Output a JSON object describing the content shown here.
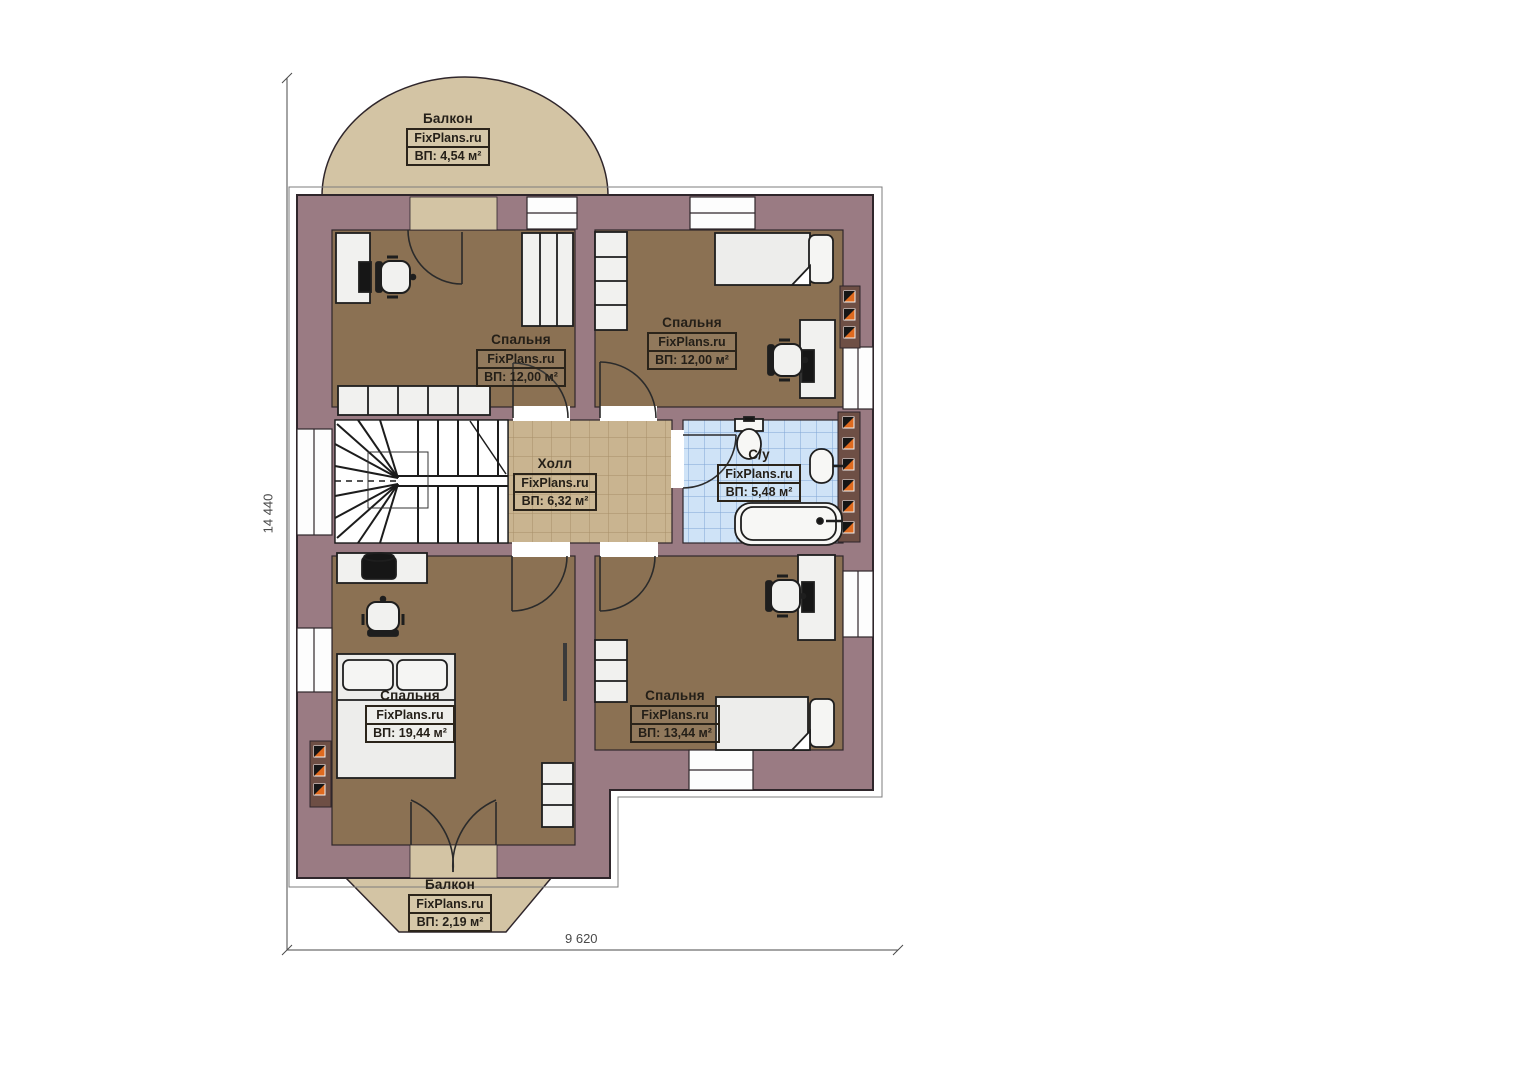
{
  "plan": {
    "watermark": "FixPlans.ru",
    "rooms": [
      {
        "id": "balcony-top",
        "name": "Балкон",
        "watermark": "FixPlans.ru",
        "area": "ВП: 4,54 м²"
      },
      {
        "id": "bedroom-top-left",
        "name": "Спальня",
        "watermark": "FixPlans.ru",
        "area": "ВП: 12,00 м²"
      },
      {
        "id": "bedroom-top-right",
        "name": "Спальня",
        "watermark": "FixPlans.ru",
        "area": "ВП: 12,00 м²"
      },
      {
        "id": "hall",
        "name": "Холл",
        "watermark": "FixPlans.ru",
        "area": "ВП: 6,32 м²"
      },
      {
        "id": "bathroom",
        "name": "С/у",
        "watermark": "FixPlans.ru",
        "area": "ВП: 5,48 м²"
      },
      {
        "id": "bedroom-bottom-left",
        "name": "Спальня",
        "watermark": "FixPlans.ru",
        "area": "ВП: 19,44 м²"
      },
      {
        "id": "bedroom-bottom-right",
        "name": "Спальня",
        "watermark": "FixPlans.ru",
        "area": "ВП: 13,44 м²"
      },
      {
        "id": "balcony-bottom",
        "name": "Балкон",
        "watermark": "FixPlans.ru",
        "area": "ВП: 2,19 м²"
      }
    ],
    "dimensions": {
      "vertical": "14 440",
      "horizontal": "9 620"
    },
    "colors": {
      "wall": "#9a7b83",
      "bedroom_floor": "#8b7153",
      "hall_floor": "#c9b490",
      "bathroom_floor": "#cfe3f7",
      "balcony": "#d3c4a4",
      "vent_accent": "#df6a1f"
    }
  }
}
